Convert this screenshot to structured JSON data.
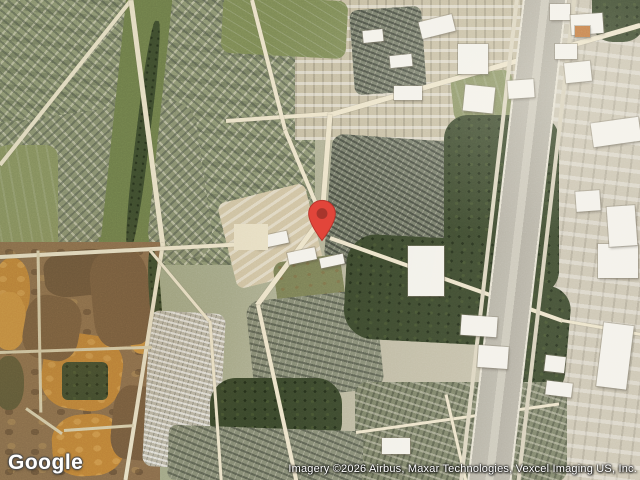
{
  "map": {
    "view_type": "satellite",
    "provider_logo": "Google",
    "attribution": "Imagery ©2026 Airbus, Maxar Technologies, Vexcel Imaging US, Inc.",
    "marker": {
      "icon": "map-pin-icon",
      "color": "#E2453A",
      "inner_color": "#9E332A"
    }
  }
}
